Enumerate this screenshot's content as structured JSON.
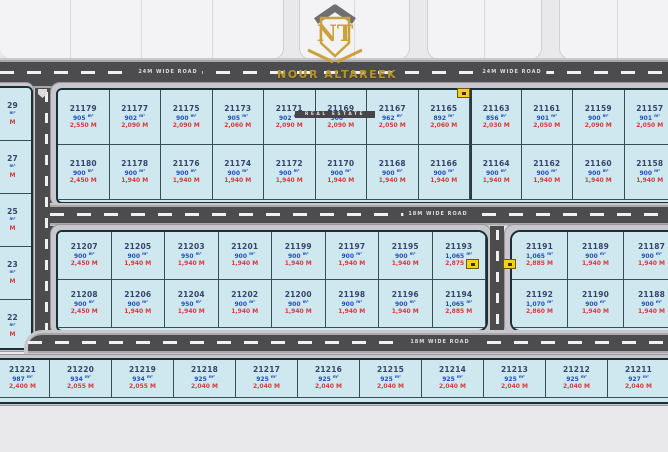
{
  "logo": {
    "monogram": "NT",
    "company": "NOUR ALTAREEK",
    "tagline": "REAL ESTATE"
  },
  "roads": {
    "top": {
      "label_left": "24M WIDE ROAD",
      "label_right": "24M WIDE ROAD"
    },
    "middle": {
      "label": "18M WIDE ROAD"
    },
    "bottom": {
      "label": "18M WIDE ROAD"
    }
  },
  "top_strip": {
    "blocks": [
      {
        "cells": 4
      },
      {
        "cells": 2
      },
      {
        "cells": 2
      },
      {
        "cells": 2
      }
    ]
  },
  "left_partial_plots": [
    {
      "number": "29",
      "area": "m²",
      "price": "M"
    },
    {
      "number": "27",
      "area": "m²",
      "price": "M"
    },
    {
      "number": "25",
      "area": "m²",
      "price": "M"
    },
    {
      "number": "23",
      "area": "m²",
      "price": "M"
    },
    {
      "number": "22",
      "area": "m²",
      "price": "M"
    }
  ],
  "blocks": {
    "block_a": {
      "rows": [
        [
          {
            "number": "21179",
            "area": "905 m²",
            "price": "2,550 M"
          },
          {
            "number": "21177",
            "area": "902 m²",
            "price": "2,090 M"
          },
          {
            "number": "21175",
            "area": "900 m²",
            "price": "2,090 M"
          },
          {
            "number": "21173",
            "area": "905 m²",
            "price": "2,060 M"
          },
          {
            "number": "21171",
            "area": "902 m²",
            "price": "2,090 M"
          },
          {
            "number": "21169",
            "area": "900 m²",
            "price": "2,090 M"
          },
          {
            "number": "21167",
            "area": "962 m²",
            "price": "2,050 M"
          },
          {
            "number": "21165",
            "area": "892 m²",
            "price": "2,060 M"
          },
          {
            "number": "21163",
            "area": "856 m²",
            "price": "2,030 M"
          },
          {
            "number": "21161",
            "area": "901 m²",
            "price": "2,050 M"
          },
          {
            "number": "21159",
            "area": "900 m²",
            "price": "2,090 M"
          },
          {
            "number": "21157",
            "area": "901 m²",
            "price": "2,050 M"
          }
        ],
        [
          {
            "number": "21180",
            "area": "900 m²",
            "price": "2,450 M"
          },
          {
            "number": "21178",
            "area": "900 m²",
            "price": "1,940 M"
          },
          {
            "number": "21176",
            "area": "900 m²",
            "price": "1,940 M"
          },
          {
            "number": "21174",
            "area": "900 m²",
            "price": "1,940 M"
          },
          {
            "number": "21172",
            "area": "900 m²",
            "price": "1,940 M"
          },
          {
            "number": "21170",
            "area": "900 m²",
            "price": "1,940 M"
          },
          {
            "number": "21168",
            "area": "900 m²",
            "price": "1,940 M"
          },
          {
            "number": "21166",
            "area": "900 m²",
            "price": "1,940 M"
          },
          {
            "number": "21164",
            "area": "900 m²",
            "price": "1,940 M"
          },
          {
            "number": "21162",
            "area": "900 m²",
            "price": "1,940 M"
          },
          {
            "number": "21160",
            "area": "900 m²",
            "price": "1,940 M"
          },
          {
            "number": "21158",
            "area": "900 m²",
            "price": "1,940 M"
          }
        ]
      ]
    },
    "block_b": {
      "rows": [
        [
          {
            "number": "21207",
            "area": "900 m²",
            "price": "2,450 M"
          },
          {
            "number": "21205",
            "area": "900 m²",
            "price": "1,940 M"
          },
          {
            "number": "21203",
            "area": "950 m²",
            "price": "1,940 M"
          },
          {
            "number": "21201",
            "area": "900 m²",
            "price": "1,940 M"
          },
          {
            "number": "21199",
            "area": "900 m²",
            "price": "1,940 M"
          },
          {
            "number": "21197",
            "area": "900 m²",
            "price": "1,940 M"
          },
          {
            "number": "21195",
            "area": "900 m²",
            "price": "1,940 M"
          },
          {
            "number": "21193",
            "area": "1,065 m²",
            "price": "2,875 M"
          }
        ],
        [
          {
            "number": "21208",
            "area": "900 m²",
            "price": "2,450 M"
          },
          {
            "number": "21206",
            "area": "900 m²",
            "price": "1,940 M"
          },
          {
            "number": "21204",
            "area": "950 m²",
            "price": "1,940 M"
          },
          {
            "number": "21202",
            "area": "900 m²",
            "price": "1,940 M"
          },
          {
            "number": "21200",
            "area": "900 m²",
            "price": "1,940 M"
          },
          {
            "number": "21198",
            "area": "900 m²",
            "price": "1,940 M"
          },
          {
            "number": "21196",
            "area": "900 m²",
            "price": "1,940 M"
          },
          {
            "number": "21194",
            "area": "1,065 m²",
            "price": "2,885 M"
          }
        ]
      ]
    },
    "block_c": {
      "rows": [
        [
          {
            "number": "21191",
            "area": "1,065 m²",
            "price": "2,885 M"
          },
          {
            "number": "21189",
            "area": "900 m²",
            "price": "1,940 M"
          },
          {
            "number": "21187",
            "area": "900 m²",
            "price": "1,940 M"
          }
        ],
        [
          {
            "number": "21192",
            "area": "1,070 m²",
            "price": "2,860 M"
          },
          {
            "number": "21190",
            "area": "900 m²",
            "price": "1,940 M"
          },
          {
            "number": "21188",
            "area": "900 m²",
            "price": "1,940 M"
          }
        ]
      ]
    },
    "bottom_row": {
      "rows": [
        [
          {
            "number": "21221",
            "area": "987 m²",
            "price": "2,400 M"
          },
          {
            "number": "21220",
            "area": "934 m²",
            "price": "2,055 M"
          },
          {
            "number": "21219",
            "area": "934 m²",
            "price": "2,055 M"
          },
          {
            "number": "21218",
            "area": "925 m²",
            "price": "2,040 M"
          },
          {
            "number": "21217",
            "area": "925 m²",
            "price": "2,040 M"
          },
          {
            "number": "21216",
            "area": "925 m²",
            "price": "2,040 M"
          },
          {
            "number": "21215",
            "area": "925 m²",
            "price": "2,040 M"
          },
          {
            "number": "21214",
            "area": "925 m²",
            "price": "2,040 M"
          },
          {
            "number": "21213",
            "area": "925 m²",
            "price": "2,040 M"
          },
          {
            "number": "21212",
            "area": "925 m²",
            "price": "2,040 M"
          },
          {
            "number": "21211",
            "area": "927 m²",
            "price": "2,040 M"
          }
        ]
      ]
    }
  },
  "colors": {
    "plot_fill": "#cfe8ef",
    "plot_number": "#36456a",
    "area_text": "#1e4fc2",
    "price_text": "#d43b3b",
    "road": "#4c4c4e",
    "sidewalk": "#c8c8cc",
    "marker_yellow": "#f6cf16",
    "logo_gold": "#b8962e",
    "background": "#e9e9eb"
  }
}
